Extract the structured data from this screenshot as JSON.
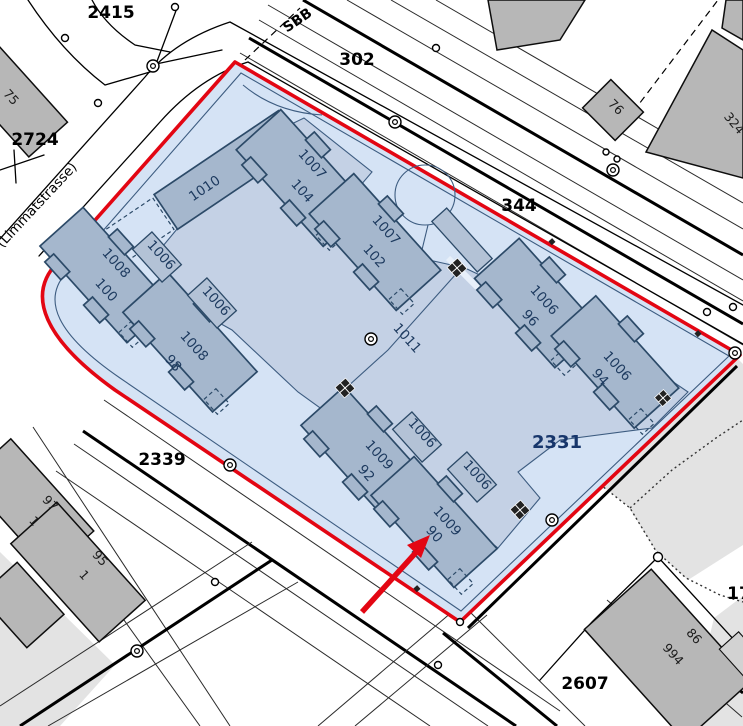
{
  "streets": {
    "limmatstrasse": "(Limmatstrasse)",
    "sbb": "SBB"
  },
  "parcels": {
    "selected": "2331",
    "p2415": "2415",
    "p2724": "2724",
    "p302": "302",
    "p344": "344",
    "p2339": "2339",
    "p2607": "2607",
    "p17": "17"
  },
  "building_numbers": {
    "b1006": "1006",
    "b1007": "1007",
    "b1008": "1008",
    "b1009": "1009",
    "b1010": "1010",
    "b1011": "1011"
  },
  "house_numbers": {
    "h90": "90",
    "h92": "92",
    "h94": "94",
    "h96": "96",
    "h98": "98",
    "h100": "100",
    "h102": "102",
    "h104": "104"
  },
  "neighbor_buildings": {
    "n75": "75",
    "n76": "76",
    "n324": "324",
    "n97": "97",
    "n95": "95",
    "n1": "1",
    "n994": "994",
    "n86": "86"
  },
  "colors": {
    "selection_fill": "#d5e3f5",
    "selection_border": "#e30613",
    "courtyard_fill": "#c4d1e5",
    "building_fill": "#a5b7cd",
    "building_outline": "#2c4a68",
    "label_blue": "#1d3a5f",
    "gray_building": "#b7b7b7",
    "arrow_red": "#e30613"
  }
}
